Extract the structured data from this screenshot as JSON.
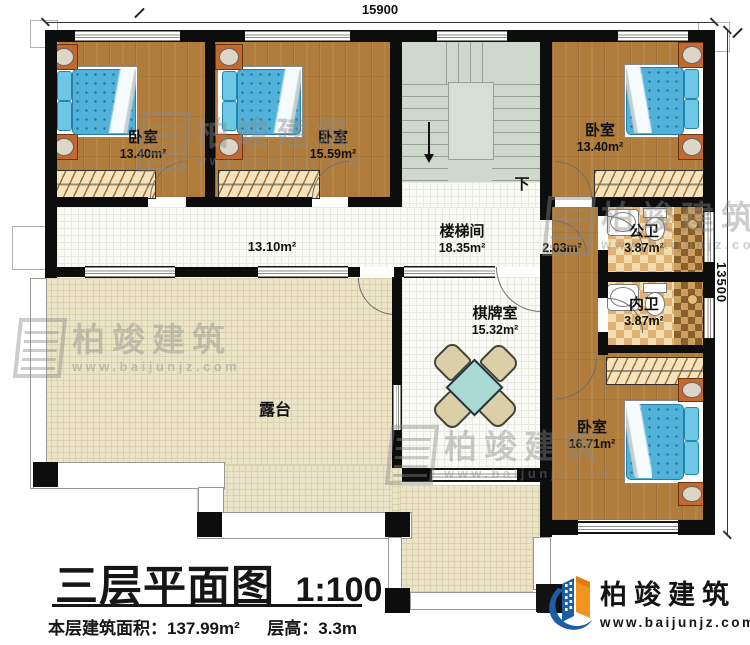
{
  "title_block": {
    "title": "三层平面图",
    "scale": "1:100",
    "area_label": "本层建筑面积：",
    "area_value": "137.99m²",
    "height_label": "层高：",
    "height_value": "3.3m"
  },
  "dimensions": {
    "top": "15900",
    "right": "13500"
  },
  "rooms": {
    "bedroom1": {
      "name": "卧室",
      "area": "13.40m²"
    },
    "bedroom2": {
      "name": "卧室",
      "area": "15.59m²"
    },
    "bedroom3": {
      "name": "卧室",
      "area": "13.40m²"
    },
    "bedroom4": {
      "name": "卧室",
      "area": "16.71m²"
    },
    "stair_hall": {
      "name": "楼梯间",
      "area": "18.35m²"
    },
    "corridor": {
      "area": "13.10m²"
    },
    "vestibule": {
      "area": "2.03m²"
    },
    "public_bath": {
      "name": "公卫",
      "area": "3.87m²"
    },
    "private_bath": {
      "name": "内卫",
      "area": "3.87m²"
    },
    "game_room": {
      "name": "棋牌室",
      "area": "15.32m²"
    },
    "terrace": {
      "name": "露台"
    }
  },
  "stairs": {
    "down_label": "下"
  },
  "brand": {
    "name": "柏竣建筑",
    "url": "www.baijunjz.com"
  },
  "watermark": {
    "name": "柏竣建筑",
    "url": "www.baijunjz.com"
  },
  "colors": {
    "wall": "#0d0d0d",
    "wood": "#b07c3c",
    "floor_grid": "#fafaf7",
    "terrace": "#ece4c9",
    "stair": "#ced8cc",
    "tile_light": "#f2ddb0",
    "tile_dark": "#dfb173",
    "mattress": "#50b2d8",
    "pillow": "#6cc8e4",
    "furniture_wood": "#c2692f",
    "table": "#aad9d3",
    "chair": "#dbcfa8",
    "logo_blue": "#1b5ea6",
    "logo_orange": "#f0941f",
    "wm": "#8a8a8a"
  }
}
